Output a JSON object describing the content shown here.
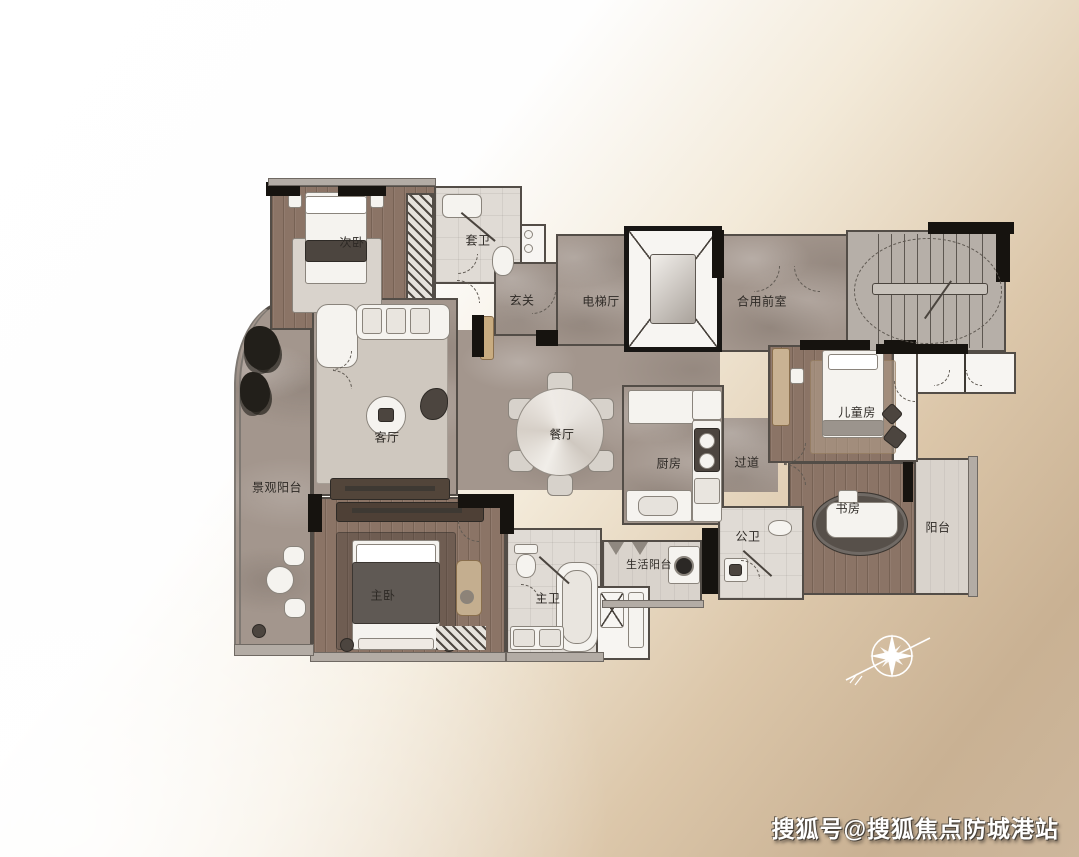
{
  "watermark": {
    "text": "搜狐号@搜狐焦点防城港站"
  },
  "rooms": [
    {
      "id": "second-bedroom",
      "label": "次卧"
    },
    {
      "id": "ensuite-bath",
      "label": "套卫"
    },
    {
      "id": "foyer",
      "label": "玄关"
    },
    {
      "id": "elevator-hall",
      "label": "电梯厅"
    },
    {
      "id": "shared-front-room",
      "label": "合用前室"
    },
    {
      "id": "living-room",
      "label": "客厅"
    },
    {
      "id": "dining-room",
      "label": "餐厅"
    },
    {
      "id": "kitchen",
      "label": "厨房"
    },
    {
      "id": "corridor",
      "label": "过道"
    },
    {
      "id": "children-room",
      "label": "儿童房"
    },
    {
      "id": "study",
      "label": "书房"
    },
    {
      "id": "balcony",
      "label": "阳台"
    },
    {
      "id": "landscape-balcony",
      "label": "景观阳台"
    },
    {
      "id": "master-bedroom",
      "label": "主卧"
    },
    {
      "id": "master-bath",
      "label": "主卫"
    },
    {
      "id": "public-bath",
      "label": "公卫"
    },
    {
      "id": "utility-balcony",
      "label": "生活阳台"
    }
  ],
  "colors": {
    "background_tan": "#c9b193",
    "marble_floor": "#a3968d",
    "wood_floor": "#8b7466",
    "wall_dark": "#16130f",
    "watermark_text": "#ffffff"
  }
}
